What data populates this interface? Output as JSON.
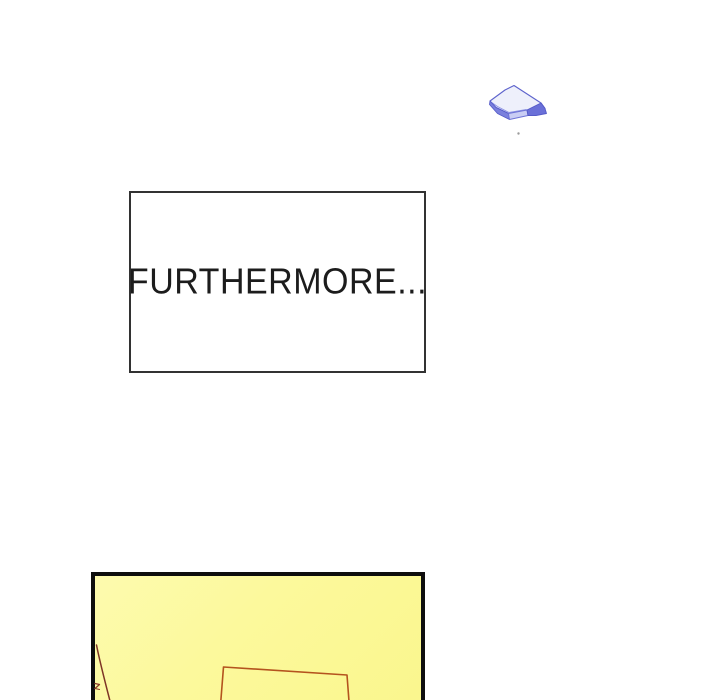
{
  "page": {
    "background_color": "#ffffff"
  },
  "caption": {
    "text": "FURTHERMORE...",
    "text_color": "#1c1c1c",
    "border_color": "#323232",
    "background_color": "#ffffff"
  },
  "panel": {
    "fill_color": "#fcf99c",
    "border_color": "#0e0e0e",
    "red_rectangle_stroke": "#b4531e",
    "brown_line_stroke": "#7e3526",
    "brown_tick_stroke": "#8a3a28"
  },
  "shard": {
    "description": "small blue crystal shard flying in upper right",
    "outline_stroke": "#5d63cc",
    "top_face_fill": "#eef0fb",
    "left_band_fill": "#7a80dd",
    "bottom_band_fill": "#c9cdf4",
    "right_tip_fill": "#6a70d8",
    "inner_line_stroke": "#8d93e4",
    "speck_color": "#9b9b9b"
  }
}
